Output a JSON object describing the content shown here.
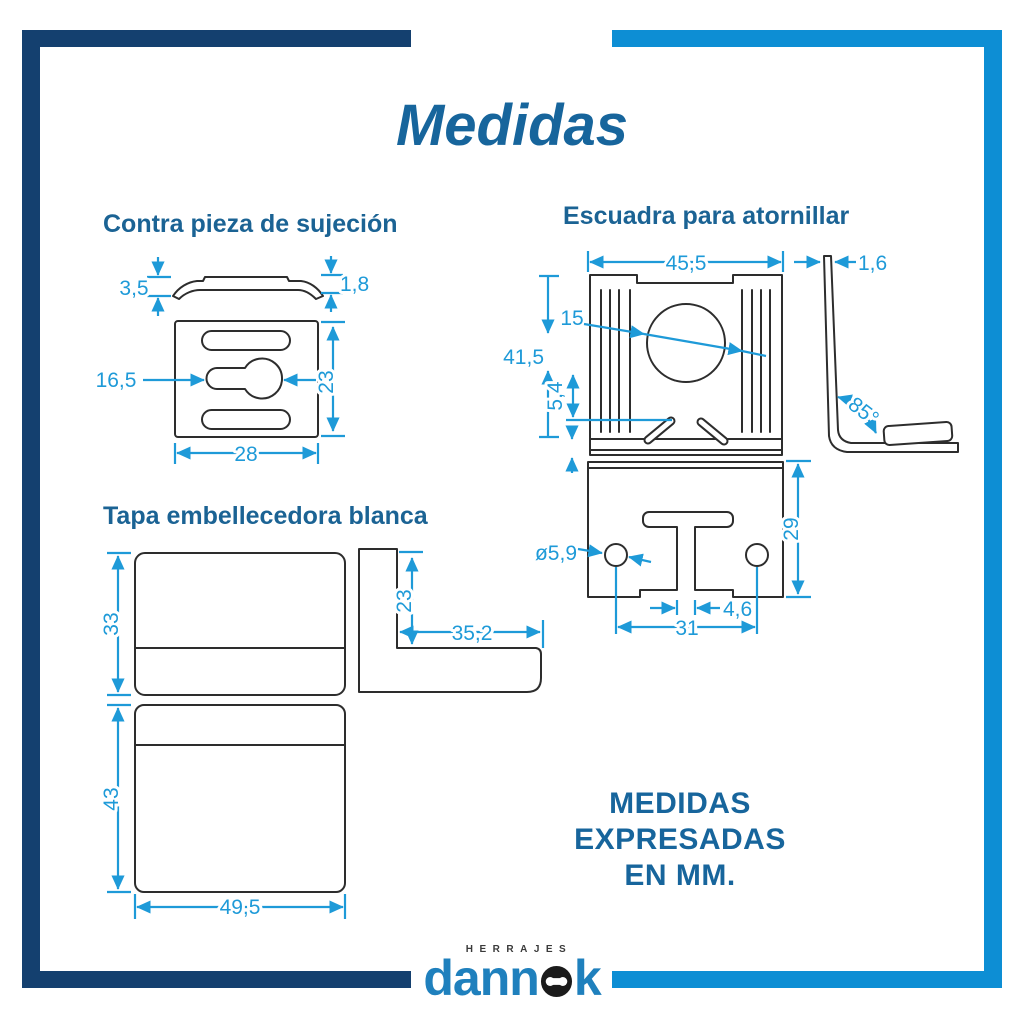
{
  "title": "Medidas",
  "note": {
    "line1": "MEDIDAS EXPRESADAS",
    "line2": "EN MM."
  },
  "colors": {
    "frame_navy": "#14406F",
    "frame_blue": "#0D8ED4",
    "heading_blue": "#1B6394",
    "dimension_blue": "#1E9AD8",
    "outline_dark": "#2D2D2D",
    "logo_blue": "#1F80BD"
  },
  "sections": {
    "contra_pieza": {
      "title": "Contra pieza de sujeción",
      "dims": {
        "altura_perfil": "3,5",
        "espesor": "1,8",
        "ranura": "16,5",
        "alto": "23",
        "ancho": "28"
      }
    },
    "escuadra": {
      "title": "Escuadra para atornillar",
      "dims": {
        "ancho": "45,5",
        "espesor": "1,6",
        "diametro_central": "15",
        "alto": "41,5",
        "offset_ranura": "5,4",
        "angulo": "85°",
        "diametro_agujero": "ø5,9",
        "alto_inferior": "29",
        "ancho_ranura": "4,6",
        "separacion_agujeros": "31"
      }
    },
    "tapa": {
      "title": "Tapa embellecedora blanca",
      "dims": {
        "alto_frontal": "33",
        "alto_lateral": "23",
        "fondo": "35,2",
        "alto_inferior": "43",
        "ancho": "49,5"
      }
    }
  },
  "logo": {
    "tagline": "HERRAJES",
    "name": "dannok",
    "name_prefix": "dann",
    "name_suffix": "k"
  }
}
